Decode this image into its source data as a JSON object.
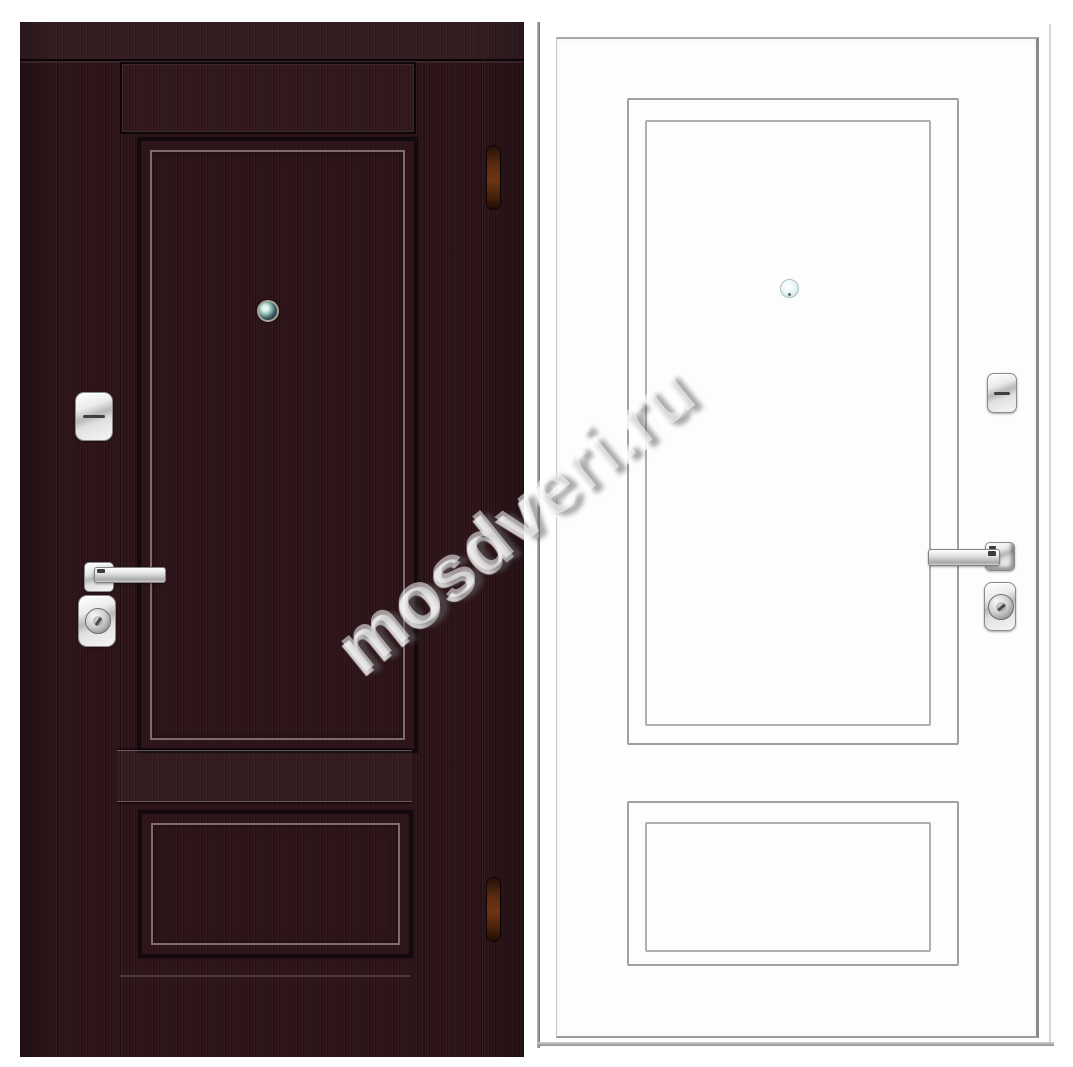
{
  "watermark": {
    "text": "mosdveri.ru"
  },
  "colors": {
    "page_bg": "#ffffff",
    "wenge_base": "#2b151a",
    "wenge_groove": "#130a0e",
    "wenge_seam": "#0b0507",
    "white_face": "#fdfdfd",
    "molding_line": "#a0a0a0",
    "door_edge": "#6d6d6d",
    "chrome_border": "#8a8a8a",
    "hinge_brown": "#6e3513",
    "lens_teal": "#35565c",
    "lens_pale": "#dcecec"
  }
}
